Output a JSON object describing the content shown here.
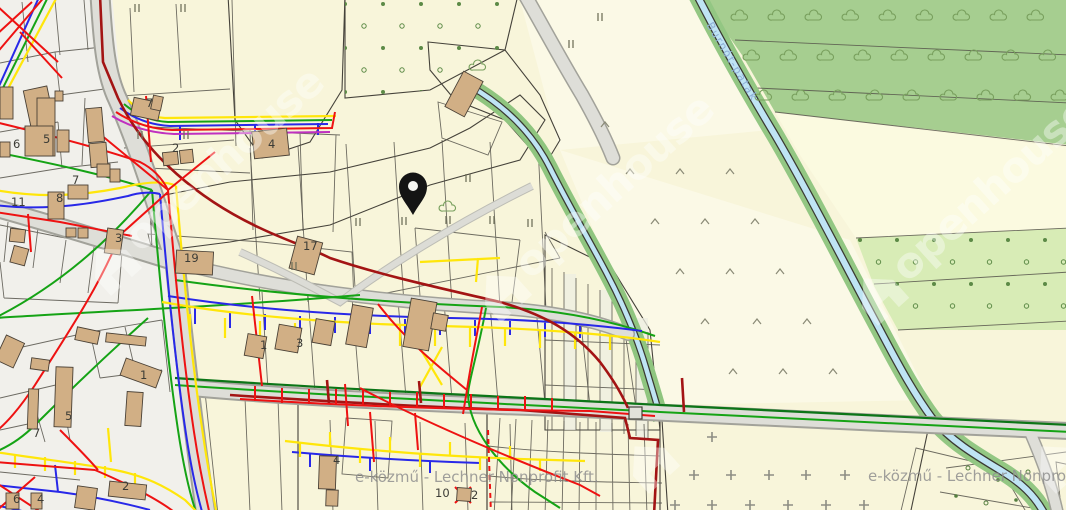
{
  "map": {
    "attribution": "e-közmű - Lechner Nonprofit Kft.",
    "brand_watermark": "openhouse",
    "stream_label": "Burnót-patak",
    "pin": {
      "x": 413,
      "y": 214
    },
    "colors": {
      "utility_red": "#EE1212",
      "utility_yellow": "#FFE60A",
      "utility_blue": "#2828E8",
      "utility_green": "#15A315",
      "utility_dark_green": "#0C7517",
      "utility_dark_red": "#A31414",
      "utility_magenta": "#C030C0",
      "water": "#BFE4F4",
      "forest": "#A6CE90",
      "orchard": "#D8ECB6",
      "field": "#F8F5DA",
      "lawn": "#90E48C",
      "olive": "#DBDF8C",
      "building": "#D1AF85",
      "pin": "#111111"
    },
    "parcel_numbers": [
      {
        "x": 43,
        "y": 143,
        "t": "5"
      },
      {
        "x": 72,
        "y": 184,
        "t": "7"
      },
      {
        "x": 56,
        "y": 202,
        "t": "8"
      },
      {
        "x": 11,
        "y": 206,
        "t": "11"
      },
      {
        "x": 13,
        "y": 148,
        "t": "6"
      },
      {
        "x": 146,
        "y": 107,
        "t": "7"
      },
      {
        "x": 172,
        "y": 152,
        "t": "2"
      },
      {
        "x": 268,
        "y": 148,
        "t": "4"
      },
      {
        "x": 184,
        "y": 262,
        "t": "19"
      },
      {
        "x": 303,
        "y": 250,
        "t": "17"
      },
      {
        "x": 115,
        "y": 242,
        "t": "3"
      },
      {
        "x": 260,
        "y": 349,
        "t": "1"
      },
      {
        "x": 296,
        "y": 347,
        "t": "3"
      },
      {
        "x": 140,
        "y": 379,
        "t": "1"
      },
      {
        "x": 65,
        "y": 420,
        "t": "5"
      },
      {
        "x": 33,
        "y": 437,
        "t": "7"
      },
      {
        "x": 122,
        "y": 490,
        "t": "2"
      },
      {
        "x": 13,
        "y": 503,
        "t": "6"
      },
      {
        "x": 37,
        "y": 503,
        "t": "4"
      },
      {
        "x": 333,
        "y": 464,
        "t": "4"
      },
      {
        "x": 435,
        "y": 497,
        "t": "10"
      },
      {
        "x": 471,
        "y": 499,
        "t": "2"
      }
    ],
    "symbols": {
      "grassland_marks": [
        [
          137,
          8
        ],
        [
          183,
          8
        ],
        [
          140,
          135
        ],
        [
          186,
          135
        ],
        [
          294,
          266
        ],
        [
          358,
          222
        ],
        [
          404,
          221
        ],
        [
          448,
          220
        ],
        [
          492,
          220
        ],
        [
          417,
          181
        ],
        [
          468,
          178
        ],
        [
          530,
          223
        ],
        [
          600,
          17
        ],
        [
          571,
          44
        ]
      ],
      "meadow_marks": [
        [
          605,
          125
        ],
        [
          630,
          172
        ],
        [
          680,
          172
        ],
        [
          730,
          172
        ],
        [
          655,
          222
        ],
        [
          705,
          222
        ],
        [
          755,
          222
        ],
        [
          680,
          272
        ],
        [
          730,
          272
        ],
        [
          780,
          272
        ],
        [
          705,
          322
        ],
        [
          757,
          322
        ],
        [
          807,
          322
        ],
        [
          733,
          372
        ],
        [
          783,
          372
        ],
        [
          833,
          372
        ]
      ],
      "vineyard_crosses": [
        [
          712,
          437
        ],
        [
          694,
          475
        ],
        [
          731,
          475
        ],
        [
          769,
          475
        ],
        [
          806,
          475
        ],
        [
          845,
          475
        ],
        [
          675,
          505
        ],
        [
          712,
          505
        ],
        [
          750,
          505
        ],
        [
          788,
          505
        ],
        [
          826,
          505
        ],
        [
          864,
          505
        ]
      ],
      "tree_rows": {
        "step": 37,
        "rows": [
          {
            "y": 18,
            "x0": 740,
            "xmax": 1060
          },
          {
            "y": 58,
            "x0": 752,
            "xmax": 1060
          },
          {
            "y": 98,
            "x0": 764,
            "xmax": 1060
          }
        ]
      },
      "single_trees": [
        [
          478,
          68
        ],
        [
          448,
          209
        ]
      ],
      "dot_grid_orchard": {
        "x0": 345,
        "xmax": 514,
        "step": 38,
        "rows": [
          4,
          26,
          48,
          70,
          92
        ]
      },
      "dot_grid_band": {
        "x0": 860,
        "xmax": 1064,
        "step": 37,
        "rows": [
          240,
          262,
          284,
          306
        ]
      },
      "corner_dots": [
        [
          968,
          468
        ],
        [
          998,
          480
        ],
        [
          1028,
          472
        ],
        [
          956,
          496
        ],
        [
          986,
          503
        ],
        [
          1016,
          500
        ]
      ]
    }
  }
}
